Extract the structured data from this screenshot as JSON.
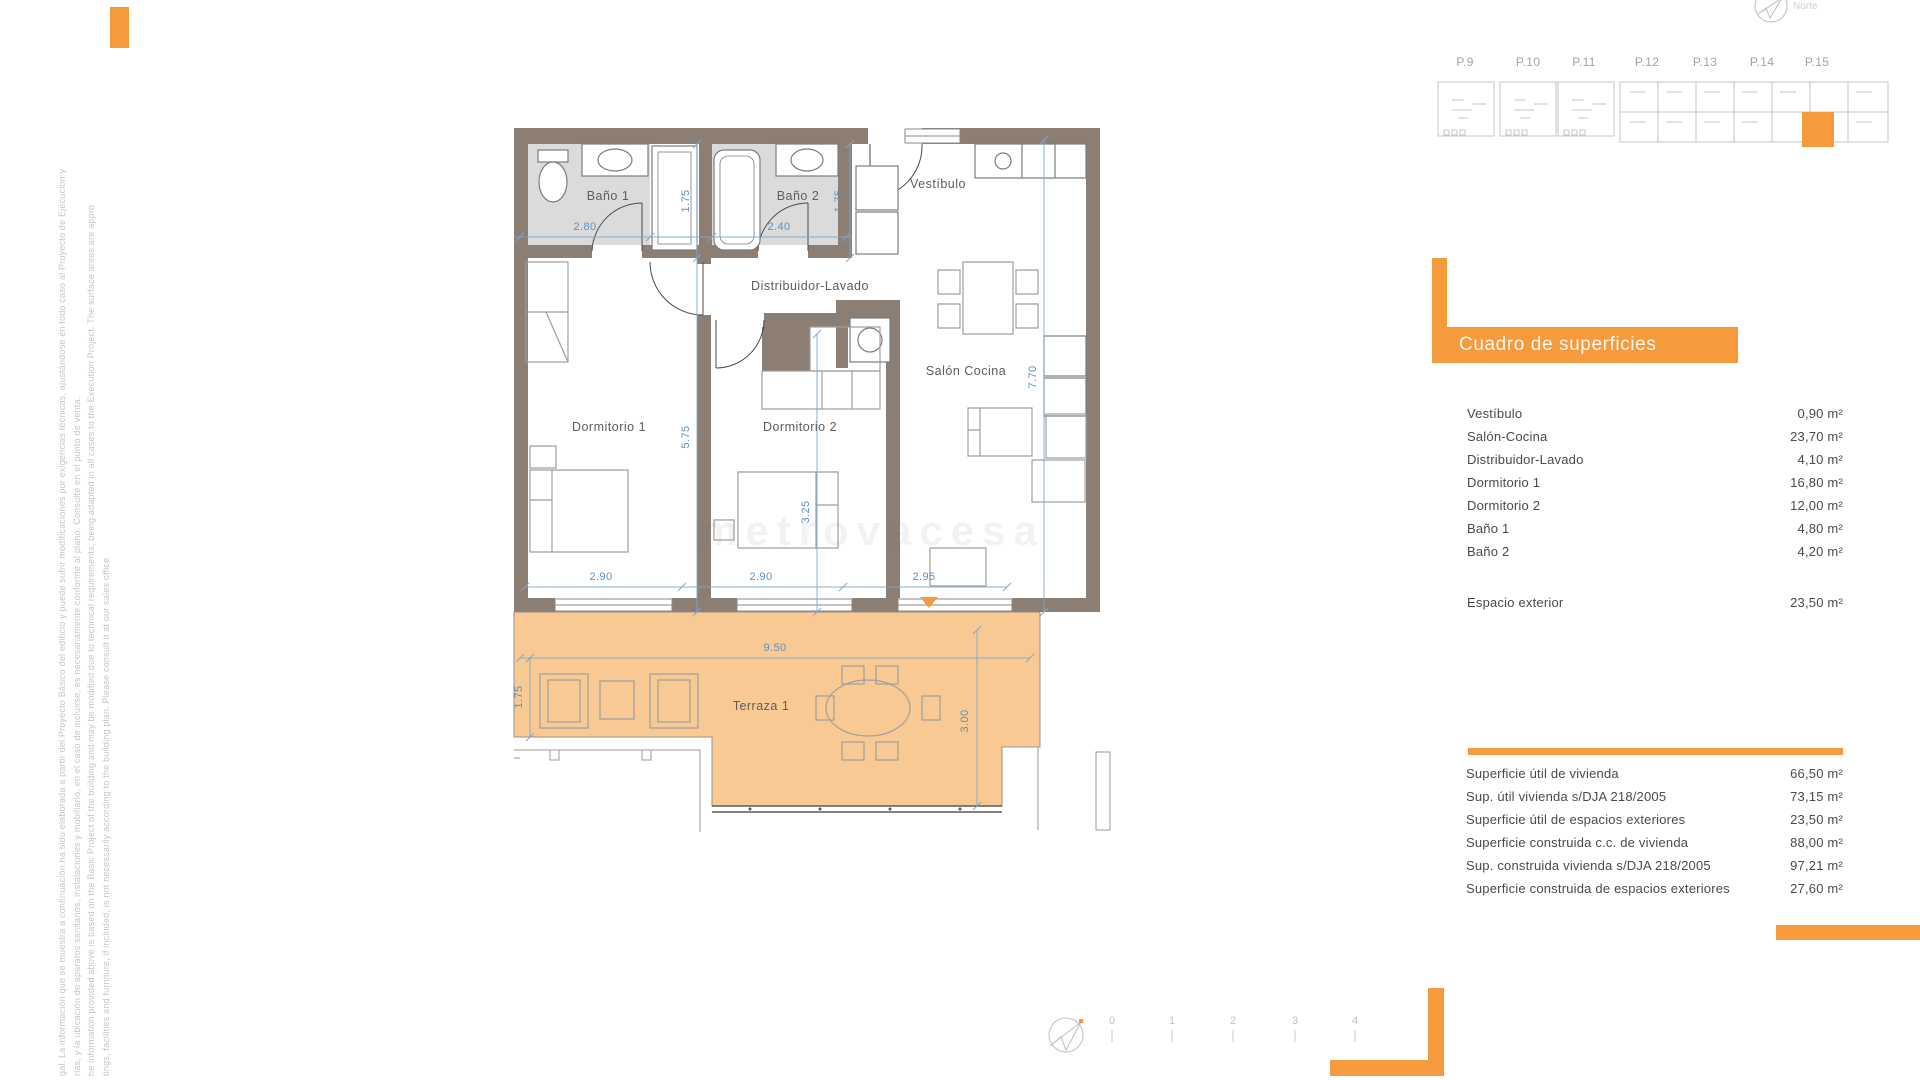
{
  "colors": {
    "accent_orange": "#F59B3D",
    "terrace_fill": "#F8C992",
    "wall": "#8C7E73",
    "bath_floor": "#DBDBDB",
    "dim_blue": "#7FA8D0",
    "dim_text": "#5B90C4"
  },
  "north": {
    "label": "Norte"
  },
  "mini_plans": {
    "labels": [
      "P.9",
      "P.10",
      "P.11",
      "P.12",
      "P.13",
      "P.14",
      "P.15"
    ]
  },
  "plan": {
    "room_labels": {
      "bano1": "Baño 1",
      "bano2": "Baño 2",
      "vestibulo": "Vestíbulo",
      "distribuidor": "Distribuidor-Lavado",
      "dormitorio1": "Dormitorio 1",
      "dormitorio2": "Dormitorio 2",
      "salon": "Salón Cocina",
      "terraza": "Terraza 1"
    },
    "dims": {
      "bano1_w": "2.80",
      "bano2_w": "2.40",
      "bano1_h": "1.75",
      "bano2_h": "1.75",
      "dorm1_h": "5.75",
      "dorm2_h": "3.25",
      "salon_h": "7.70",
      "dorm1_w": "2.90",
      "dorm2_w": "2.90",
      "salon_w": "2.95",
      "terraza_w": "9.50",
      "terraza_h_left": "1.75",
      "terraza_h_right": "3.00"
    },
    "watermark": "metrovacesa"
  },
  "surfaces": {
    "title": "Cuadro de superficies",
    "rows": [
      {
        "label": "Vestíbulo",
        "value": "0,90 m²"
      },
      {
        "label": "Salón-Cocina",
        "value": "23,70 m²"
      },
      {
        "label": "Distribuidor-Lavado",
        "value": "4,10 m²"
      },
      {
        "label": "Dormitorio 1",
        "value": "16,80 m²"
      },
      {
        "label": "Dormitorio 2",
        "value": "12,00 m²"
      },
      {
        "label": "Baño 1",
        "value": "4,80 m²"
      },
      {
        "label": "Baño 2",
        "value": "4,20 m²"
      },
      {
        "label": "Espacio exterior",
        "value": "23,50 m²"
      }
    ]
  },
  "summary": {
    "rows": [
      {
        "label": "Superficie útil de vivienda",
        "value": "66,50 m²"
      },
      {
        "label": "Sup. útil vivienda s/DJA 218/2005",
        "value": "73,15 m²"
      },
      {
        "label": "Superficie útil de espacios exteriores",
        "value": "23,50 m²"
      },
      {
        "label": "Superficie construida c.c. de vivienda",
        "value": "88,00 m²"
      },
      {
        "label": "Sup. construida vivienda s/DJA 218/2005",
        "value": "97,21 m²"
      },
      {
        "label": "Superficie construida de espacios exteriores",
        "value": "27,60 m²"
      }
    ]
  },
  "scale": {
    "ticks": [
      "0",
      "1",
      "2",
      "3",
      "4"
    ]
  },
  "disclaimer": {
    "lines": [
      "gal. La información que se muestra a continuación ha sido elaborada a partir del Proyecto Básico del edificio y puede sufrir modificaciones por exigencias técnicas, ajustándose en todo caso al Proyecto de Ejecución y",
      "rias, y la ubicación de aparatos sanitarios, instalaciones y mobiliario, en el caso de incluirse, es necesariamente conforme al plano. Consulte en el punto de venta.",
      "he information provided above is based on the Basic Project of the building and may be modified due to technical requirements, being adapted in all cases to the Execution Project. The surface areas are appro",
      "tings, facilities and furniture, if included, is not necessarily according to the building plan. Please consult it at our sales office."
    ]
  }
}
